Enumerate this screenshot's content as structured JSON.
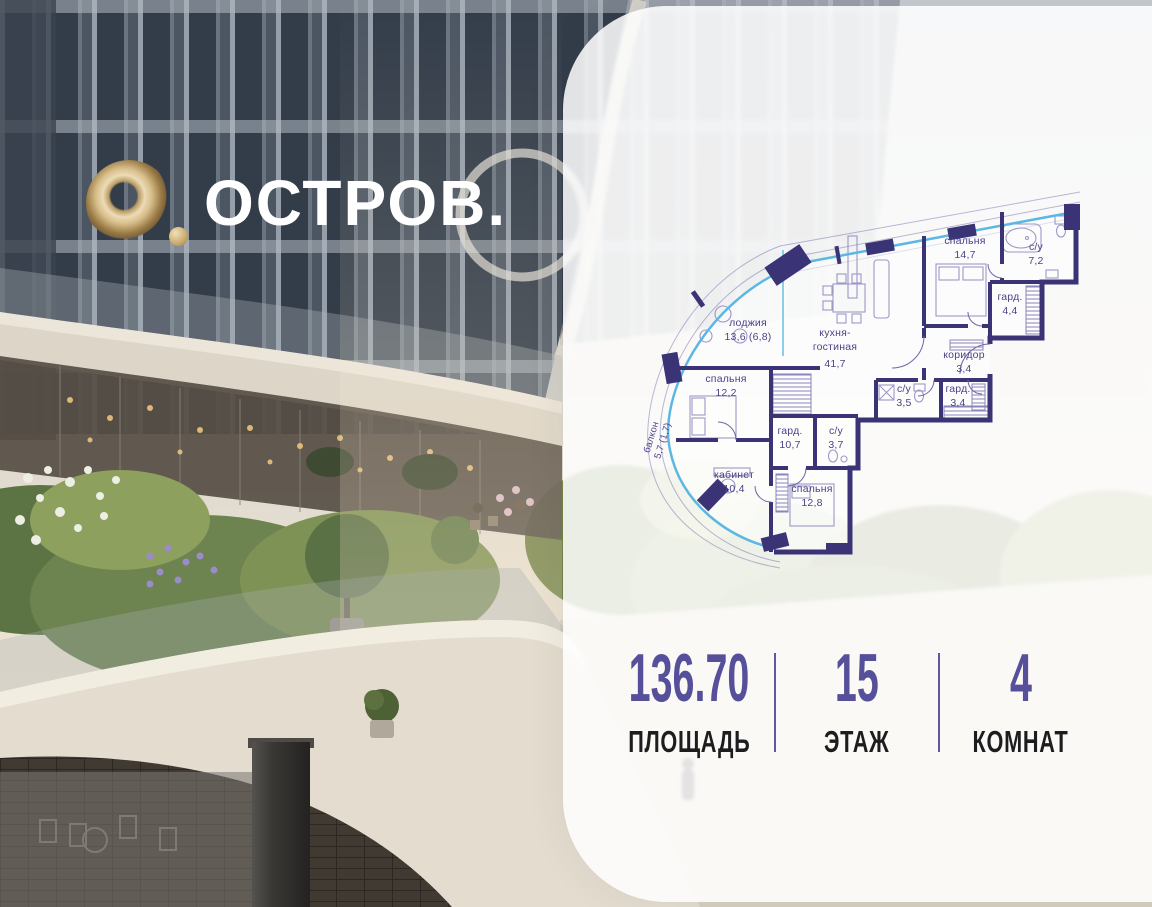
{
  "logo": {
    "brand": "ОСТРОВ.",
    "mark": "gold-torus-O"
  },
  "floorplan": {
    "rooms": [
      {
        "name": "спальня",
        "area": "14,7"
      },
      {
        "name": "с/у",
        "area": "7,2"
      },
      {
        "name": "гард.",
        "area": "4,4"
      },
      {
        "name": "коридор",
        "area": "3,4"
      },
      {
        "name": "гард.",
        "area": "3,4"
      },
      {
        "name": "с/у",
        "area": "3,5"
      },
      {
        "name": "лоджия",
        "area": "13,6 (6,8)"
      },
      {
        "name": "кухня-",
        "name2": "гостиная",
        "area": "41,7"
      },
      {
        "name": "спальня",
        "area": "12,2"
      },
      {
        "name": "гард.",
        "area": "10,7"
      },
      {
        "name": "с/у",
        "area": "3,7"
      },
      {
        "name": "балкон",
        "area": "5,7 (1,7)"
      },
      {
        "name": "кабинет",
        "area": "10,4"
      },
      {
        "name": "спальня",
        "area": "12,8"
      }
    ]
  },
  "stats": [
    {
      "value": "136.70",
      "label": "ПЛОЩАДЬ"
    },
    {
      "value": "15",
      "label": "ЭТАЖ"
    },
    {
      "value": "4",
      "label": "КОМНАТ"
    }
  ],
  "colors": {
    "accent": "#56509B",
    "wall": "#3A3376",
    "glazing": "#5BB7E3",
    "plan_label": "#4A4387",
    "gold": "#C9AB72",
    "stat_label": "#1D1D1F"
  }
}
